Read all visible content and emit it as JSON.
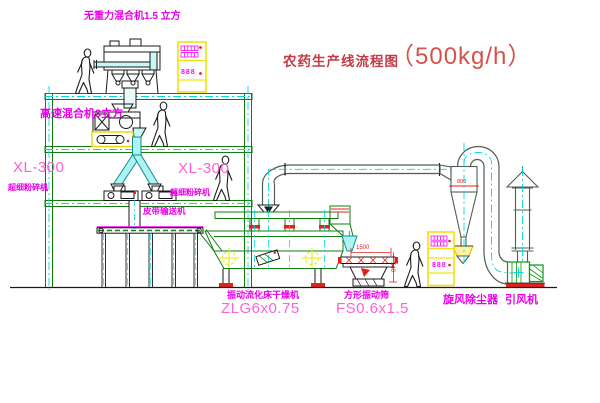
{
  "title": {
    "cn": "农药生产线流程图",
    "capacity": "（500kg/h）"
  },
  "labels": {
    "top_mixer": "无重力混合机1.5 立方",
    "highspeed_mixer": "高速混合机3立方",
    "xl300_left": {
      "model": "XL-300",
      "name": "超细粉碎机"
    },
    "xl300_mid": {
      "model": "XL-300",
      "name": "超细粉碎机"
    },
    "belt_conveyor": "皮带输送机",
    "dryer": {
      "name": "振动流化床干燥机",
      "model": "ZLG6x0.75"
    },
    "screen": {
      "name": "方形振动筛",
      "model": "FS0.6x1.5"
    },
    "cyclone": "旋风除尘器",
    "fan": "引风机"
  },
  "dimensions": {
    "screen_length": "1500",
    "screen_height": "540",
    "cyclone_dia": "800"
  },
  "cabinets": {
    "top_display": "888",
    "right_display": "888"
  },
  "colors": {
    "structure_green": "#0f7d0f",
    "duct_green": "#4f5f52",
    "fan_green": "#0a9a0a",
    "centerline_cyan": "#00d9d9",
    "chute_cyan_fill": "#aff2f2",
    "label_magenta": "#e800e8",
    "model_pink": "#ff5fd7",
    "accent_red": "#e32119",
    "cabinet_yellow": "#f2e20a",
    "title_red": "#c43a46",
    "ink_black": "#1a1a1a"
  }
}
